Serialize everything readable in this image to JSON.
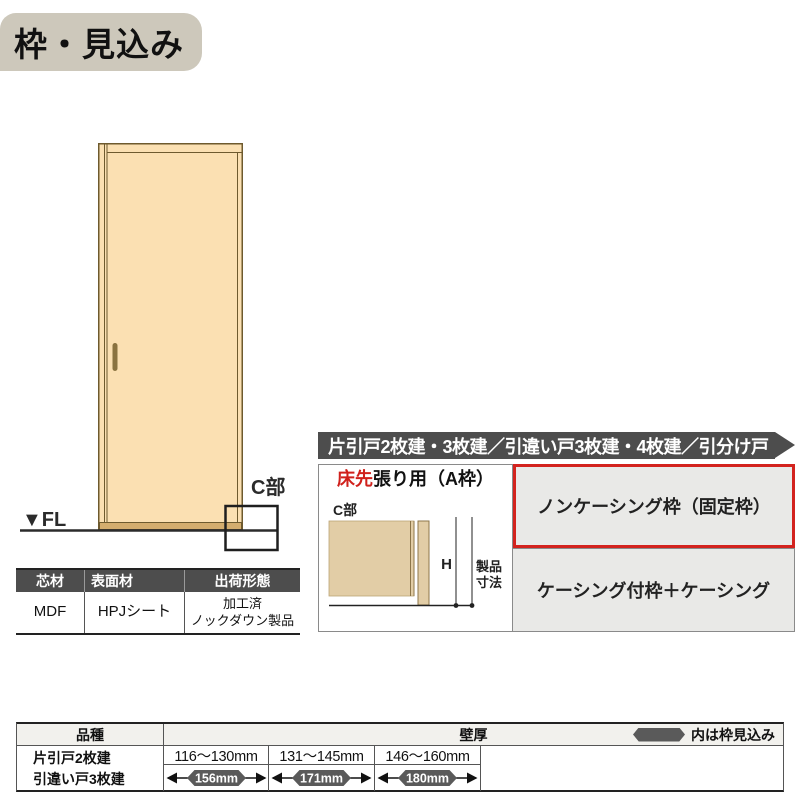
{
  "page": {
    "title": "枠・見込み"
  },
  "door_figure": {
    "fl_label": "▼FL",
    "c_label": "C部"
  },
  "material_table": {
    "headers": [
      "芯材",
      "表面材",
      "出荷形態"
    ],
    "row": {
      "core": "MDF",
      "surface": "HPJシート",
      "shipping_line1": "加工済",
      "shipping_line2": "ノックダウン製品"
    }
  },
  "frame_panel": {
    "header": "片引戸2枚建・3枚建／引違い戸3枚建・4枚建／引分け戸",
    "floor_type_red": "床先",
    "floor_type_rest": "張り用（A枠）",
    "diagram": {
      "c_label": "C部",
      "h_label": "H",
      "product_line1": "製品",
      "product_line2": "寸法"
    },
    "options": [
      {
        "label": "ノンケーシング枠（固定枠）",
        "highlighted": true
      },
      {
        "label": "ケーシング付枠＋ケーシング",
        "highlighted": false
      }
    ]
  },
  "spec_table": {
    "col_product": "品種",
    "col_wall": "壁厚",
    "legend": "内は枠見込み",
    "products": [
      "片引戸2枚建",
      "引違い戸3枚建"
    ],
    "columns": [
      {
        "range": "116～130mm",
        "frame": "156mm"
      },
      {
        "range": "131～145mm",
        "frame": "171mm"
      },
      {
        "range": "146～160mm",
        "frame": "180mm"
      }
    ]
  },
  "colors": {
    "dark_bar": "#4d4d4d",
    "title_bg": "#cdc8bb",
    "door_fill": "#fbe0b2",
    "door_line": "#6e5a2e",
    "diagram_tan": "#e2cda6",
    "option_bg": "#e9e9e7",
    "highlight_red": "#d3231e",
    "hexagon": "#5a5a5a",
    "spec_header_bg": "#f2f1ed"
  }
}
